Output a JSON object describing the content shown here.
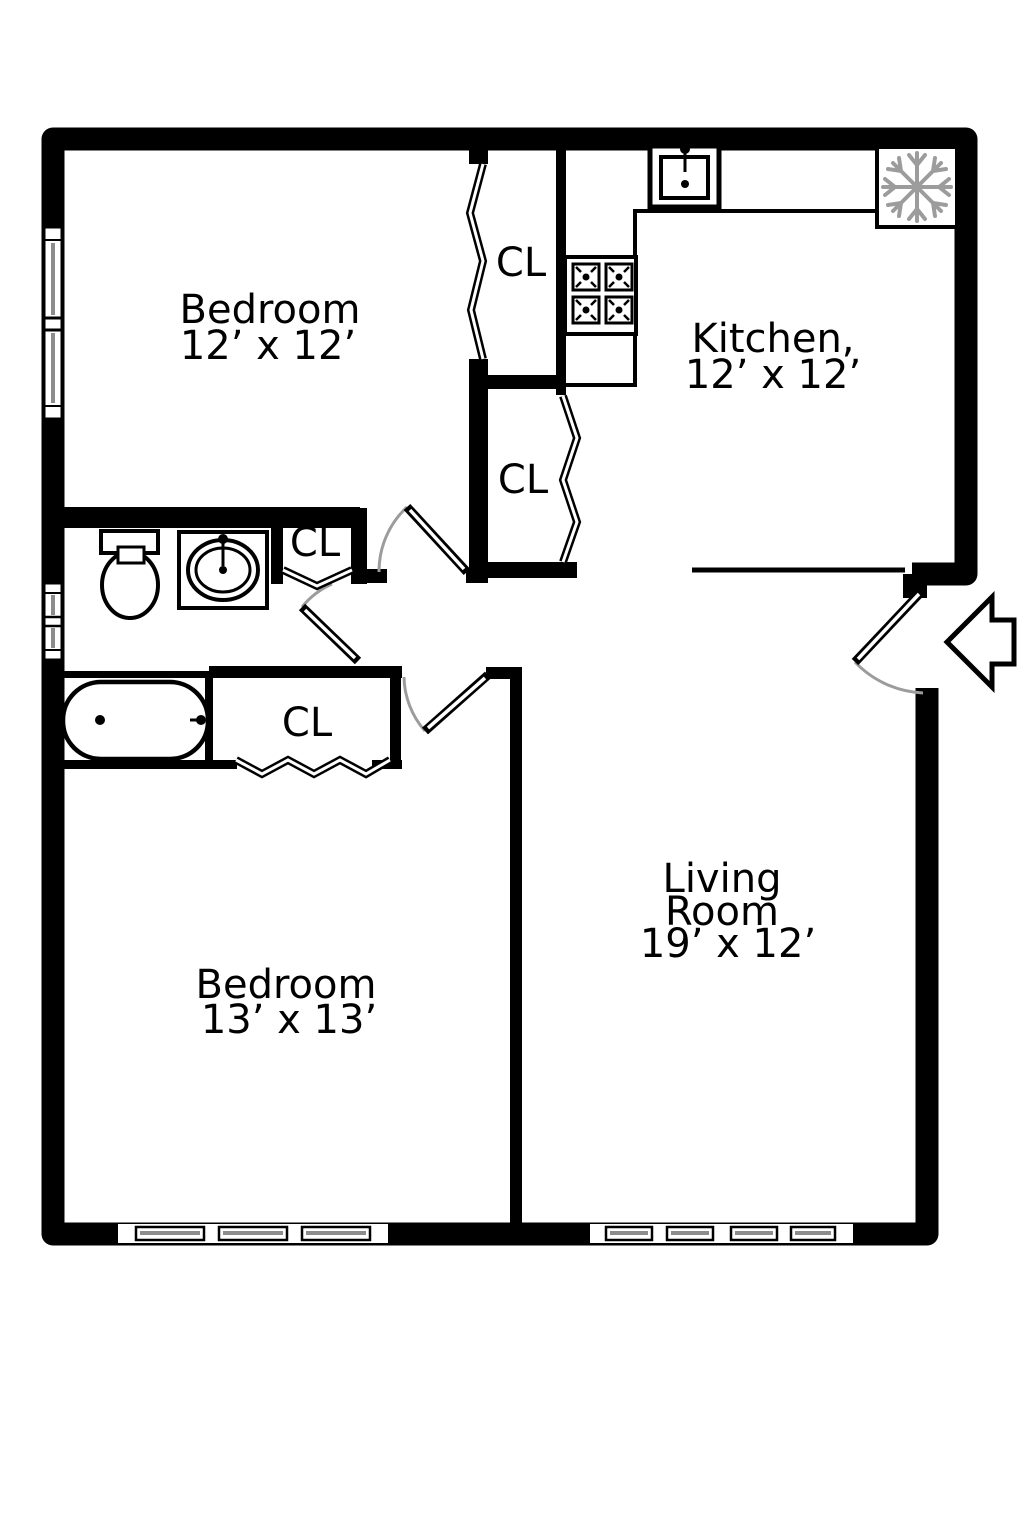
{
  "rooms": {
    "bedroom_top": {
      "name": "Bedroom",
      "dims": "12’ x 12’"
    },
    "kitchen": {
      "name": "Kitchen,",
      "dims": "12’ x 12’"
    },
    "living_room": {
      "name_line1": "Living",
      "name_line2": "Room",
      "dims": "19’ x 12’"
    },
    "bedroom_bottom": {
      "name": "Bedroom",
      "dims": "13’ x 13’"
    }
  },
  "closets": [
    {
      "label": "CL"
    },
    {
      "label": "CL"
    },
    {
      "label": "CL"
    },
    {
      "label": "CL"
    }
  ],
  "icons": {
    "refrigerator": "snowflake-icon",
    "stove": "four-burner-stove-icon",
    "kitchen_sink": "sink-icon",
    "bathroom_sink": "oval-sink-icon",
    "toilet": "toilet-icon",
    "bathtub": "bathtub-icon",
    "entry": "entry-arrow-icon"
  },
  "colors": {
    "wall": "#000000",
    "background": "#ffffff",
    "door_arc": "#9c9c9c",
    "window_glass": "#8c8c8c",
    "snowflake": "#9c9c9c"
  }
}
